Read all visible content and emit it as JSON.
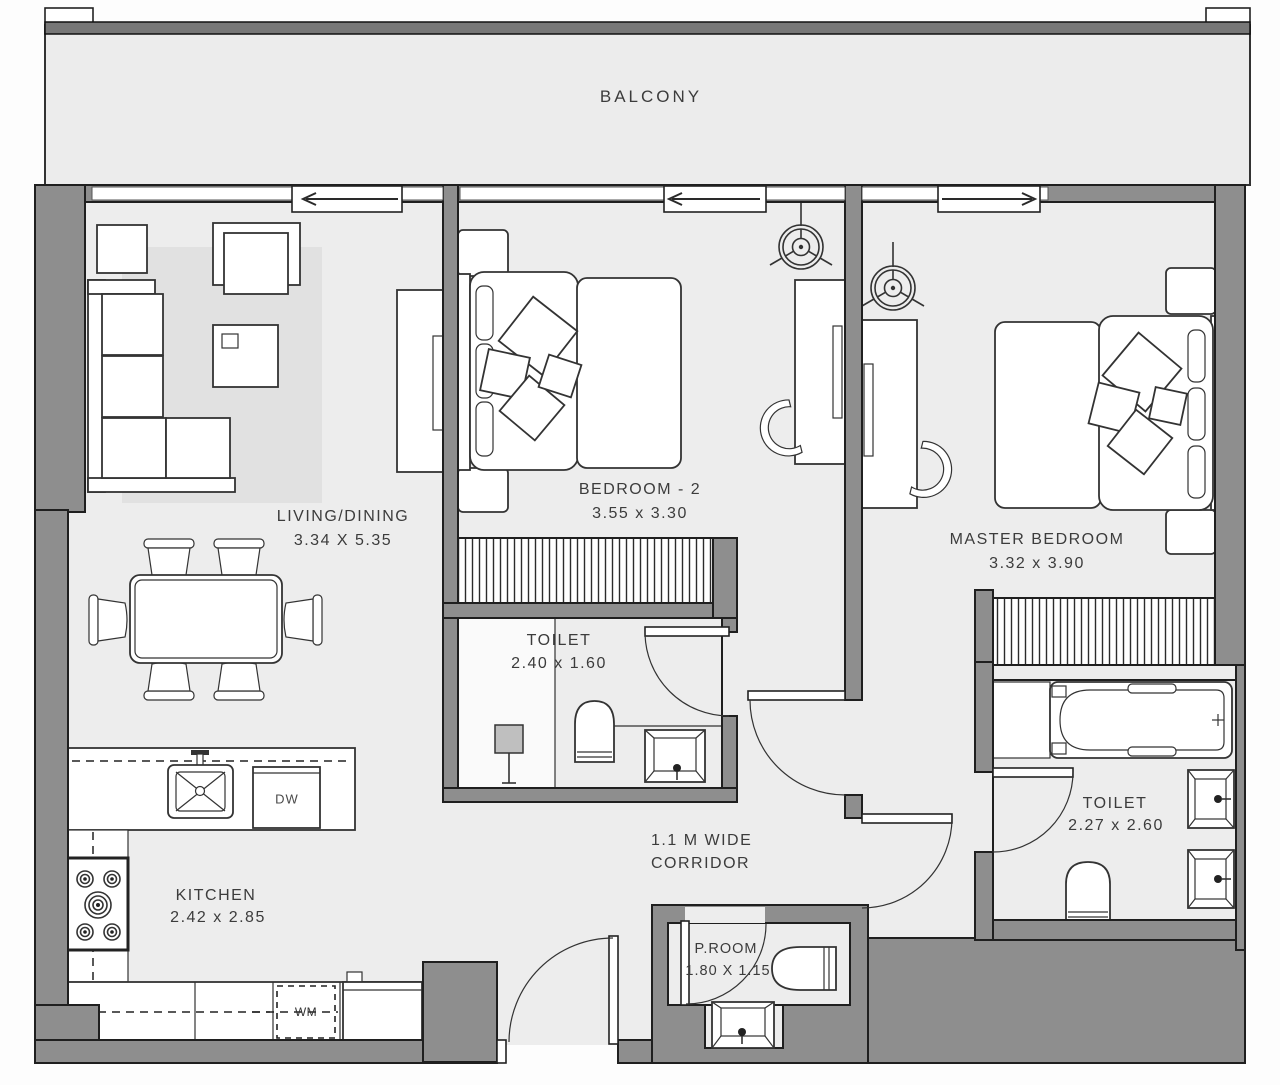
{
  "plan": {
    "balcony": {
      "label": "BALCONY"
    },
    "living_dining": {
      "label": "LIVING/DINING",
      "dimensions": "3.34 X 5.35"
    },
    "bedroom_2": {
      "label": "BEDROOM - 2",
      "dimensions": "3.55 x 3.30"
    },
    "master_bedroom": {
      "label": "MASTER BEDROOM",
      "dimensions": "3.32 x 3.90"
    },
    "toilet_2": {
      "label": "TOILET",
      "dimensions": "2.40 x 1.60"
    },
    "master_toilet": {
      "label": "TOILET",
      "dimensions": "2.27 x 2.60"
    },
    "kitchen": {
      "label": "KITCHEN",
      "dimensions": "2.42 x 2.85"
    },
    "corridor": {
      "line1": "1.1 M WIDE",
      "line2": "CORRIDOR"
    },
    "powder_room": {
      "label": "P.ROOM",
      "dimensions": "1.80 X 1.15"
    },
    "appliances": {
      "dishwasher": "DW",
      "washing_machine": "WM"
    }
  },
  "colors": {
    "wall": "#8e8e8e",
    "floor": "#ededed",
    "rug": "#e1e1e1",
    "outline": "#1f1f1f",
    "text": "#3c3c3c",
    "furniture": "#ffffff"
  }
}
